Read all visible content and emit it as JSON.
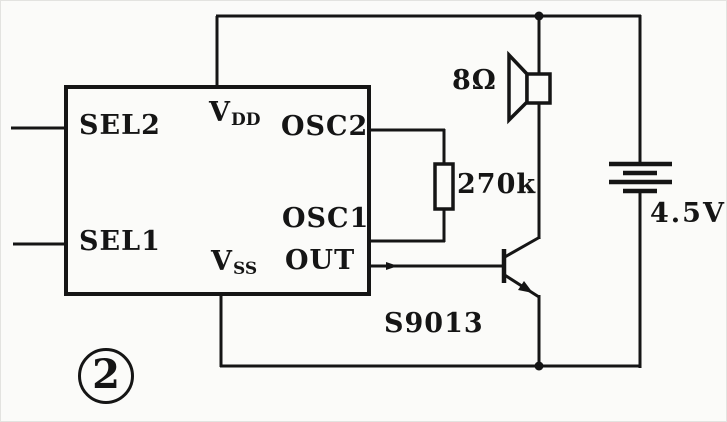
{
  "colors": {
    "ink": "#151515",
    "paper": "#fbfbf9"
  },
  "caption": {
    "number": "2"
  },
  "ic": {
    "pin_sel2": "SEL2",
    "pin_sel1": "SEL1",
    "pin_vdd": {
      "base": "V",
      "sub": "DD"
    },
    "pin_vss": {
      "base": "V",
      "sub": "SS"
    },
    "pin_osc2": "OSC2",
    "pin_osc1": "OSC1",
    "pin_out": "OUT"
  },
  "speaker": {
    "impedance": "8Ω"
  },
  "resistor": {
    "value": "270k"
  },
  "battery": {
    "voltage": "4.5V"
  },
  "transistor": {
    "part": "S9013"
  }
}
